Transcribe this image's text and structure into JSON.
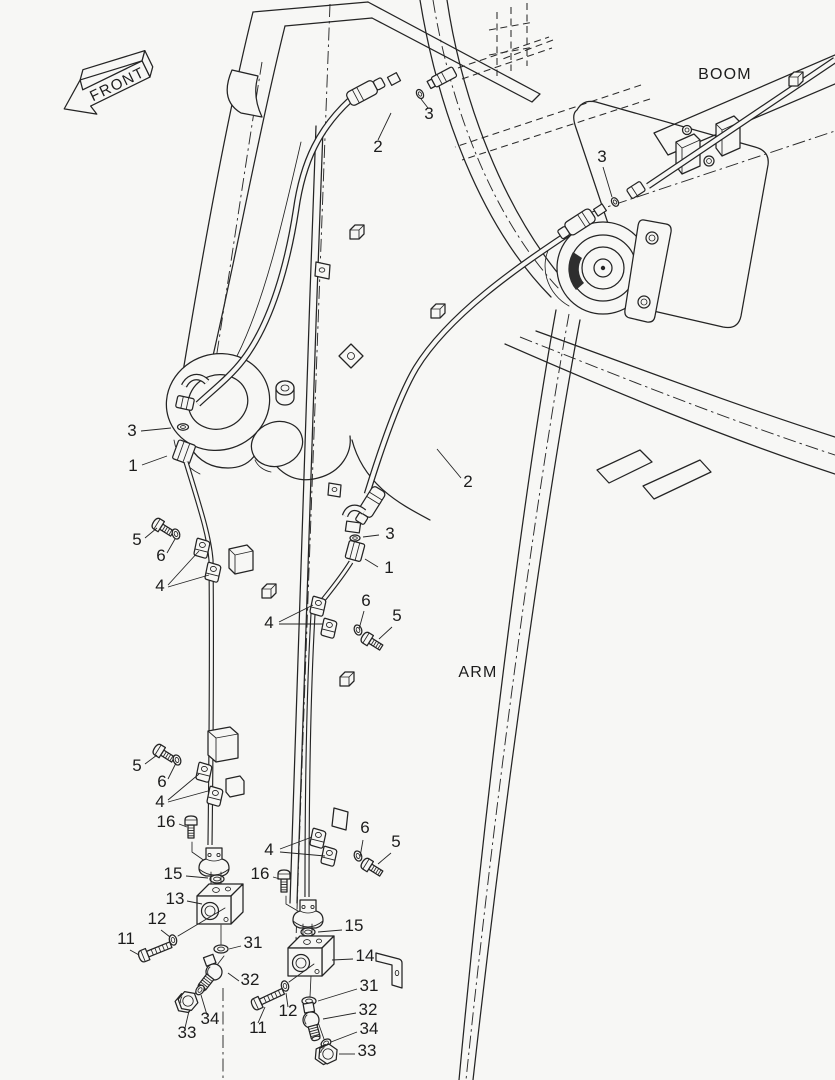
{
  "page": {
    "background": "#f7f7f5",
    "line_color": "#242424"
  },
  "labels": {
    "front": "FRONT",
    "boom": "BOOM",
    "arm": "ARM"
  },
  "callouts": {
    "top_hose": "2",
    "top_washer": "3",
    "boom_washer": "3",
    "left_washer": "3",
    "left_elbow": "1",
    "left_bolt_upper": "5",
    "left_washer_upper": "6",
    "left_clamp_upper": "4",
    "right_hose": "2",
    "right_washer": "3",
    "right_elbow": "1",
    "right_washer_upper": "6",
    "right_bolt_upper": "5",
    "right_clamp_upper": "4",
    "left_bolt_lower": "5",
    "left_washer_lower": "6",
    "left_clamp_lower": "4",
    "left_bolt16": "16",
    "left_washer15": "15",
    "left_block13": "13",
    "left_washer12": "12",
    "left_bolt11": "11",
    "left_ring31": "31",
    "left_elbow32": "32",
    "left_washer34": "34",
    "left_nut33": "33",
    "right_clamp_lower": "4",
    "right_washer_lower": "6",
    "right_bolt_lower": "5",
    "right_bolt16": "16",
    "right_washer15": "15",
    "right_block14": "14",
    "right_ring31": "31",
    "right_bolt11": "11",
    "right_washer12": "12",
    "right_elbow32": "32",
    "right_washer34": "34",
    "right_nut33": "33"
  }
}
